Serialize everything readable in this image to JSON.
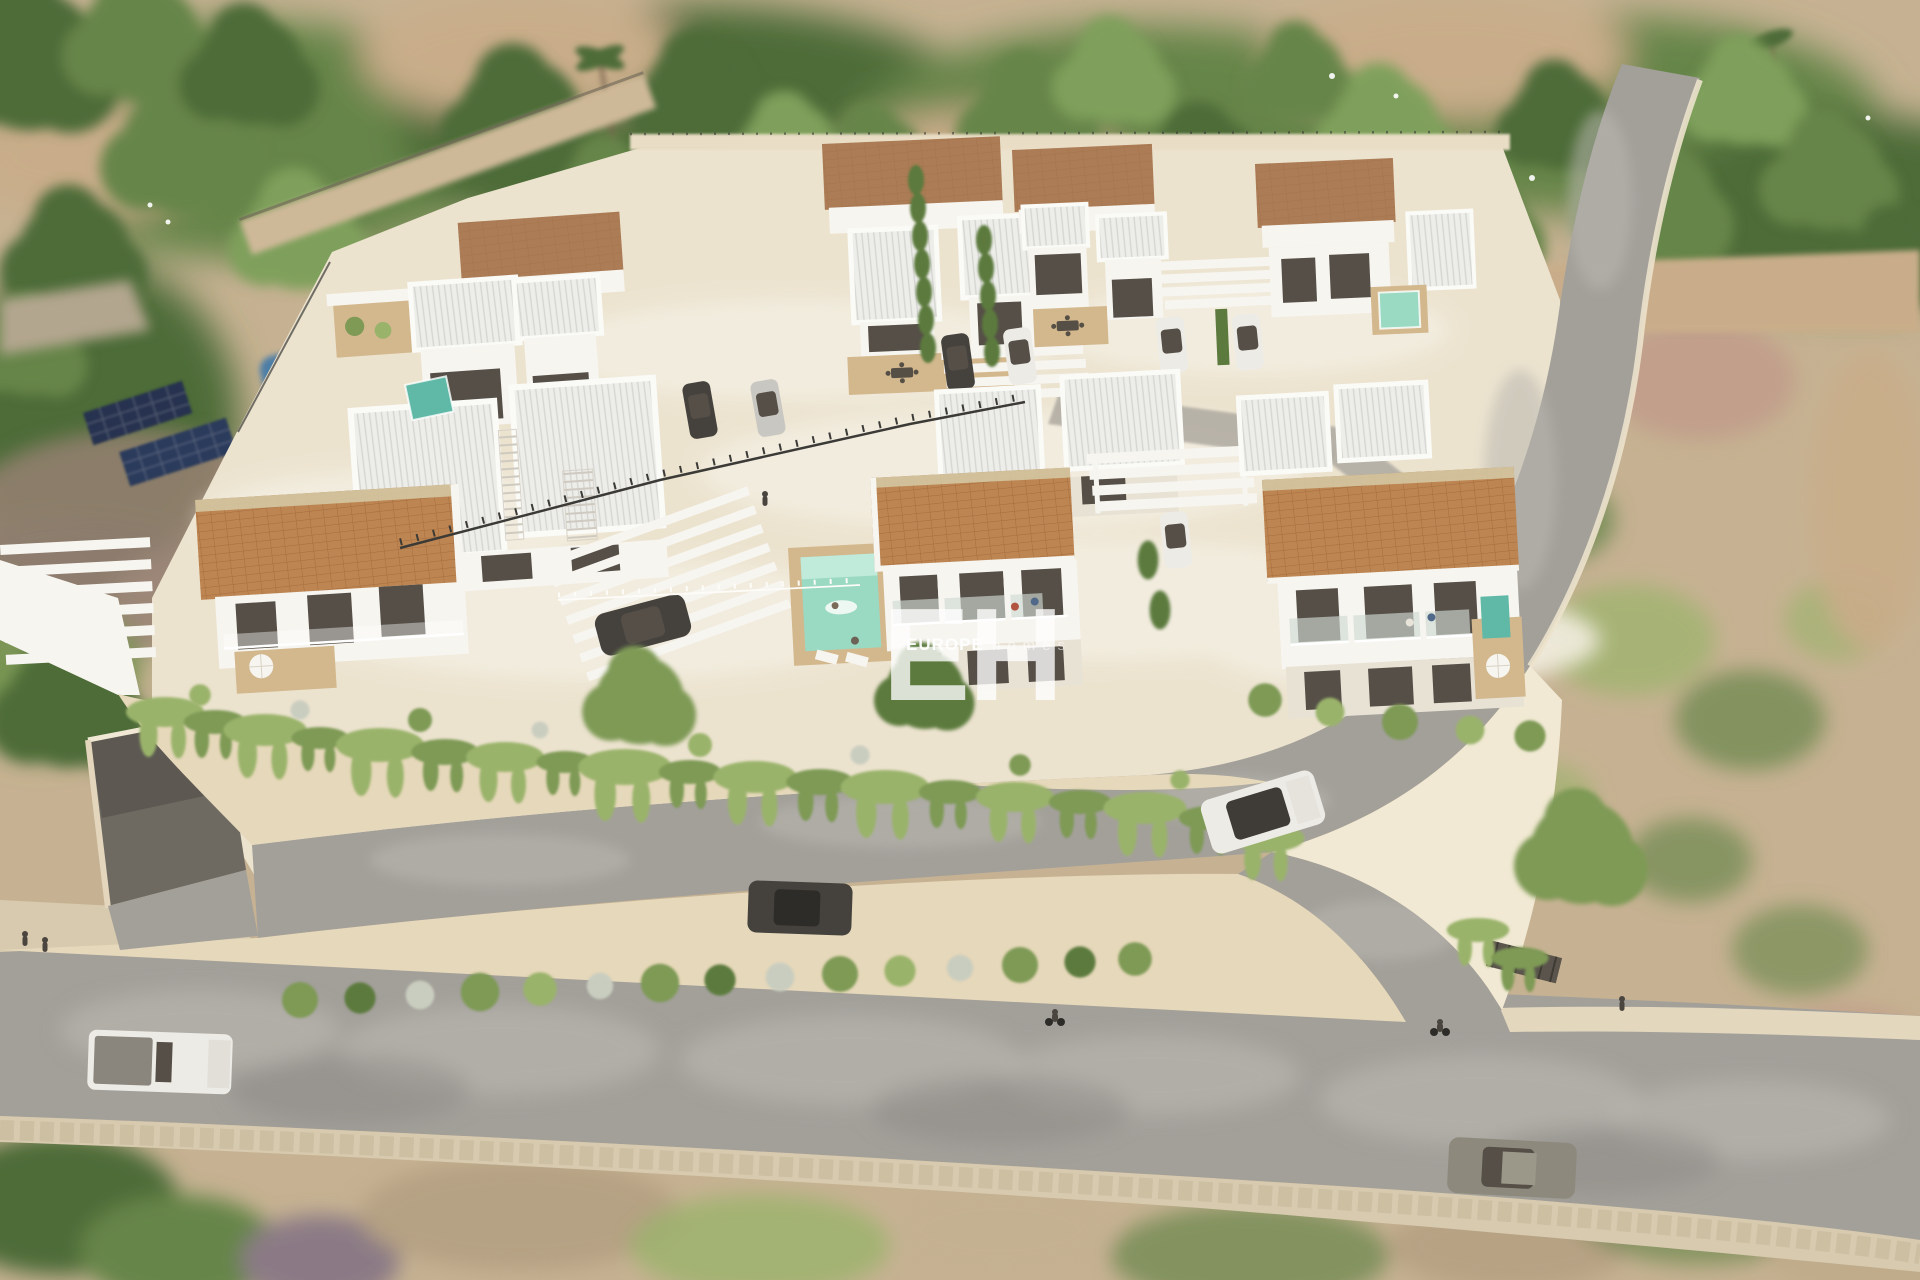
{
  "watermark": {
    "monogram": "EH",
    "brand_primary": "EUROPE",
    "brand_secondary": "homes"
  },
  "palette": {
    "scrub_base": "#c6b292",
    "canopy_dark": "#4e6c39",
    "canopy_mid": "#66854a",
    "canopy_light": "#7fa05c",
    "dirt_path": "#c9ad8a",
    "platform_cream": "#ece3cf",
    "terrace_light": "#f3eee1",
    "wall_cream": "#e6d8ba",
    "wall_bright": "#f1e9d3",
    "road_gray": "#a3a09a",
    "road_mottle": "#bab7b0",
    "sidewalk": "#d7caae",
    "terracotta": "#bd8551",
    "roof_brown": "#ab7c55",
    "ridge_khaki": "#d3c7a2",
    "ribbed_white": "#ededea",
    "villa_white": "#f7f5f0",
    "villa_shade": "#e8e2d5",
    "glass_dark": "#554f47",
    "pool_teal": "#9ad9c2",
    "pool_light": "#c9efe0",
    "pool_deep": "#5fb9a6",
    "neighbor_pool": "#4e7ea6",
    "solar_navy": "#26334f",
    "deck_tan": "#d3b88e",
    "hedge_green": "#7e9a55",
    "hedge_dark": "#5c7a3e",
    "hedge_light": "#9ab36b",
    "flower_gray": "#c9cdbf",
    "car_dark": "#45423e",
    "car_white": "#edebe6",
    "car_silver": "#c9c7c1",
    "car_olive": "#8d8a7d",
    "fence_dark": "#3b3a36",
    "watermark": "#ffffff"
  }
}
